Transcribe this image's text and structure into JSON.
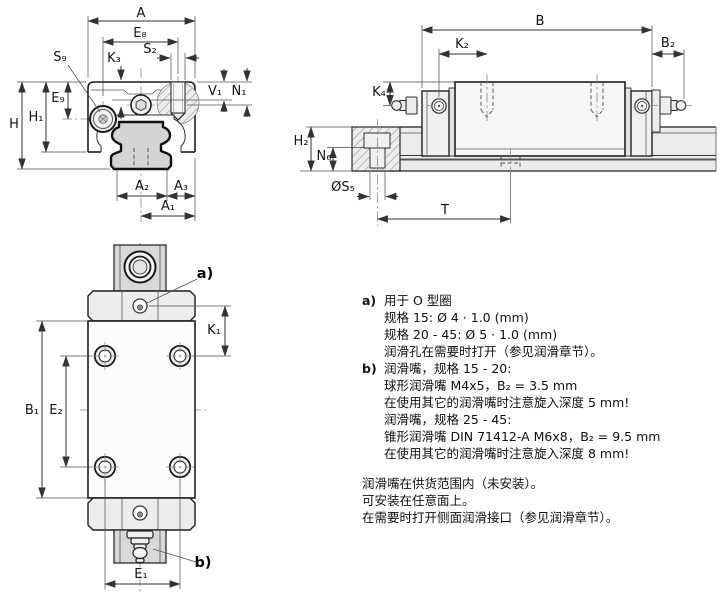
{
  "figure": {
    "type": "technical dimensional drawing",
    "subject": "linear guide carriage on profiled rail, three views with lubrication notes"
  },
  "dim_labels": {
    "front": {
      "A": "A",
      "E8": "E₈",
      "S9": "S₉",
      "K3": "K₃",
      "S2": "S₂",
      "V1": "V₁",
      "N1": "N₁",
      "H": "H",
      "H1": "H₁",
      "E9": "E₉",
      "A2": "A₂",
      "A3": "A₃",
      "A1": "A₁"
    },
    "side": {
      "B": "B",
      "K2": "K₂",
      "B2": "B₂",
      "K4": "K₄",
      "H2": "H₂",
      "N6": "N₆",
      "S5": "ØS₅",
      "T": "T"
    },
    "top": {
      "B1": "B₁",
      "E2": "E₂",
      "K1": "K₁",
      "E1": "E₁",
      "callout_a": "a)",
      "callout_b": "b)"
    }
  },
  "notes": {
    "a_label": "a)",
    "a_lines": [
      "用于 O 型圈",
      "规格 15: Ø 4 · 1.0 (mm)",
      "规格 20 - 45: Ø 5 · 1.0 (mm)",
      "润滑孔在需要时打开（参见润滑章节）。"
    ],
    "b_label": "b)",
    "b_lines": [
      "润滑嘴，规格 15 - 20:",
      "球形润滑嘴 M4x5，B₂ = 3.5 mm",
      "在使用其它的润滑嘴时注意旋入深度 5 mm!",
      "润滑嘴，规格 25 - 45:",
      "锥形润滑嘴 DIN 71412-A M6x8，B₂ = 9.5 mm",
      "在使用其它的润滑嘴时注意旋入深度 8 mm!"
    ],
    "footer_lines": [
      "润滑嘴在供货范围内（未安装）。",
      "可安装在任意面上。",
      "在需要时打开侧面润滑接口（参见润滑章节）。"
    ]
  },
  "colors": {
    "line": "#1f1f1f",
    "dim_line": "#333333",
    "body_fill": "#f4f4f4",
    "rail_fill": "#d6d6d6",
    "hatch_line": "#8c8c8c",
    "background": "#ffffff"
  }
}
